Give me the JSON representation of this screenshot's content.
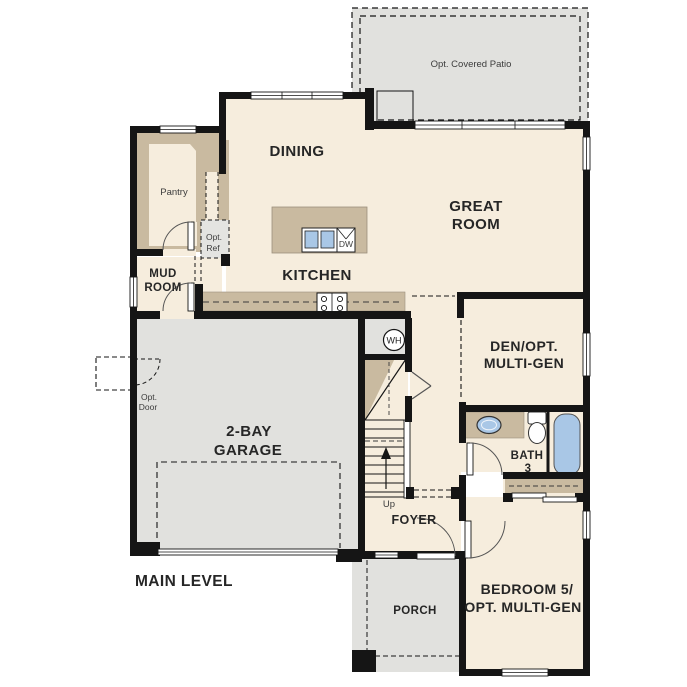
{
  "plan": {
    "level_label": "MAIN LEVEL",
    "rooms": {
      "patio": "Opt. Covered Patio",
      "dining": "DINING",
      "great_room_line1": "GREAT",
      "great_room_line2": "ROOM",
      "pantry": "Pantry",
      "kitchen": "KITCHEN",
      "mud_room_line1": "MUD",
      "mud_room_line2": "ROOM",
      "den_line1": "DEN/OPT.",
      "den_line2": "MULTI-GEN",
      "garage_line1": "2-BAY",
      "garage_line2": "GARAGE",
      "bath_line1": "BATH",
      "bath_line2": "3",
      "foyer": "FOYER",
      "porch": "PORCH",
      "bedroom_line1": "BEDROOM 5/",
      "bedroom_line2": "OPT. MULTI-GEN"
    },
    "annotations": {
      "opt_ref_line1": "Opt.",
      "opt_ref_line2": "Ref",
      "opt_door_line1": "Opt.",
      "opt_door_line2": "Door",
      "up": "Up",
      "dw": "DW",
      "wh": "WH"
    },
    "colors": {
      "floor": "#f6eddd",
      "wall_poche_tan": "#c9baa0",
      "concrete_gray": "#e1e1de",
      "fixture_blue": "#a9c7e6",
      "wall_black": "#151515"
    }
  }
}
